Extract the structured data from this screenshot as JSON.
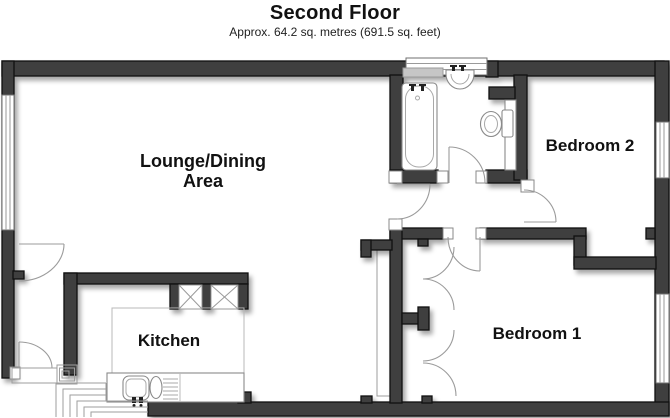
{
  "header": {
    "title": "Second Floor",
    "subtitle": "Approx. 64.2 sq. metres (691.5 sq. feet)"
  },
  "rooms": {
    "lounge_dining": {
      "line1": "Lounge/Dining",
      "line2": "Area"
    },
    "kitchen": {
      "label": "Kitchen"
    },
    "bedroom1": {
      "label": "Bedroom 1"
    },
    "bedroom2": {
      "label": "Bedroom 2"
    }
  },
  "colors": {
    "wall_fill": "#3f3f3f",
    "wall_edge": "#101010",
    "door_arc": "#9b9b9b",
    "fixture_outline": "#8a8a8a",
    "light_outline": "#9e9e9e",
    "shelf_fill": "#c6c6c6",
    "background": "#ffffff",
    "text": "#111111"
  },
  "fixtures": {
    "bathroom": [
      "bath",
      "basin",
      "toilet",
      "cabinet",
      "shelf",
      "window"
    ],
    "kitchen": [
      "counter",
      "sink-double-bowl",
      "drainer",
      "taps",
      "storage-unit-x",
      "storage-unit-x"
    ],
    "bedroom1": [
      "fitted-wardrobe-doors",
      "window"
    ],
    "bedroom2": [
      "window"
    ],
    "circulation": [
      "staircase",
      "entry-landing",
      "lobby-doors"
    ]
  }
}
